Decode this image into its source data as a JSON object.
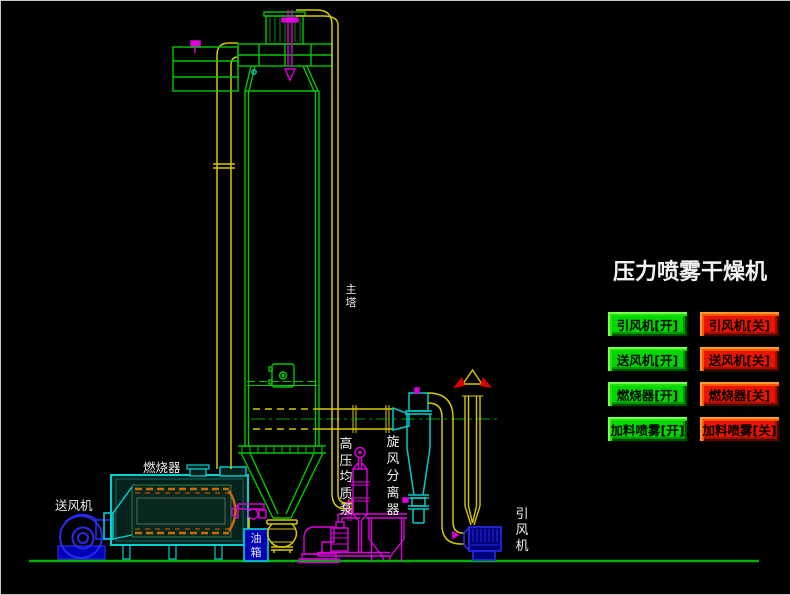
{
  "title": "压力喷雾干燥机",
  "labels": {
    "main_tower": "主塔",
    "burner": "燃烧器",
    "supply_fan": "送风机",
    "high_pressure_pump": "高压均质泵",
    "cyclone_separator": "旋风分离器",
    "oil_tank": "油箱",
    "induced_fan": "引风机"
  },
  "buttons": [
    {
      "label": "引风机[开]",
      "state": "on"
    },
    {
      "label": "引风机[关]",
      "state": "off"
    },
    {
      "label": "送风机[开]",
      "state": "on"
    },
    {
      "label": "送风机[关]",
      "state": "off"
    },
    {
      "label": "燃烧器[开]",
      "state": "on"
    },
    {
      "label": "燃烧器[关]",
      "state": "off"
    },
    {
      "label": "加料喷雾[开]",
      "state": "on"
    },
    {
      "label": "加料喷雾[关]",
      "state": "off"
    }
  ],
  "colors": {
    "background": "#000000",
    "pipe_yellow": "#d8c800",
    "equipment_green": "#00c800",
    "cyan": "#00cccc",
    "magenta": "#cc00cc",
    "blue": "#2222dd",
    "flame_orange": "#cc6a00",
    "button_on": "#00d600",
    "button_off": "#ea1400",
    "arrow_red": "#dd0000",
    "ground_green": "#00b000",
    "label_white": "#ececec"
  }
}
